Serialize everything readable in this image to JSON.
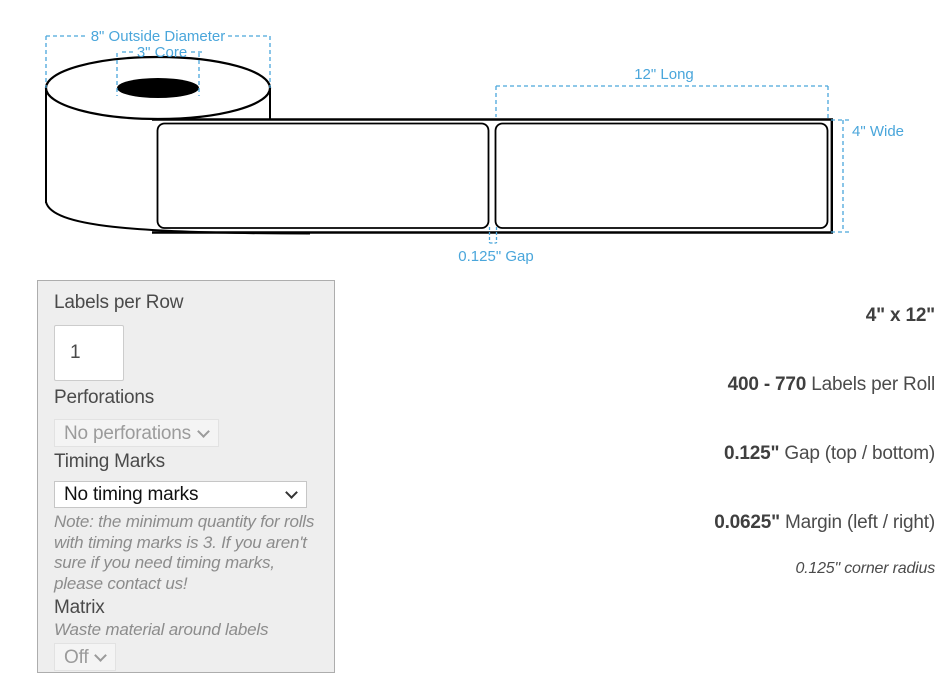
{
  "diagram": {
    "outside_diameter_label": "8\" Outside Diameter",
    "core_label": "3\" Core",
    "length_label": "12\" Long",
    "width_label": "4\" Wide",
    "gap_label": "0.125\" Gap",
    "colors": {
      "annotation_blue": "#4aa6db",
      "line_black": "#000000"
    }
  },
  "form": {
    "labels_per_row": {
      "label": "Labels per Row",
      "value": "1"
    },
    "perforations": {
      "label": "Perforations",
      "value": "No perforations"
    },
    "timing_marks": {
      "label": "Timing Marks",
      "value": "No timing marks",
      "note": "Note: the minimum quantity for rolls with timing marks is 3. If you aren't sure if you need timing marks, please contact us!"
    },
    "matrix": {
      "label": "Matrix",
      "description": "Waste material around labels",
      "value": "Off"
    }
  },
  "specs": {
    "size": "4\" x 12\"",
    "labels_per_roll_value": "400 - 770",
    "labels_per_roll_text": " Labels per Roll",
    "gap_value": "0.125\"",
    "gap_text": " Gap (top / bottom)",
    "margin_value": "0.0625\"",
    "margin_text": " Margin (left / right)",
    "corner_radius": "0.125\" corner radius"
  }
}
